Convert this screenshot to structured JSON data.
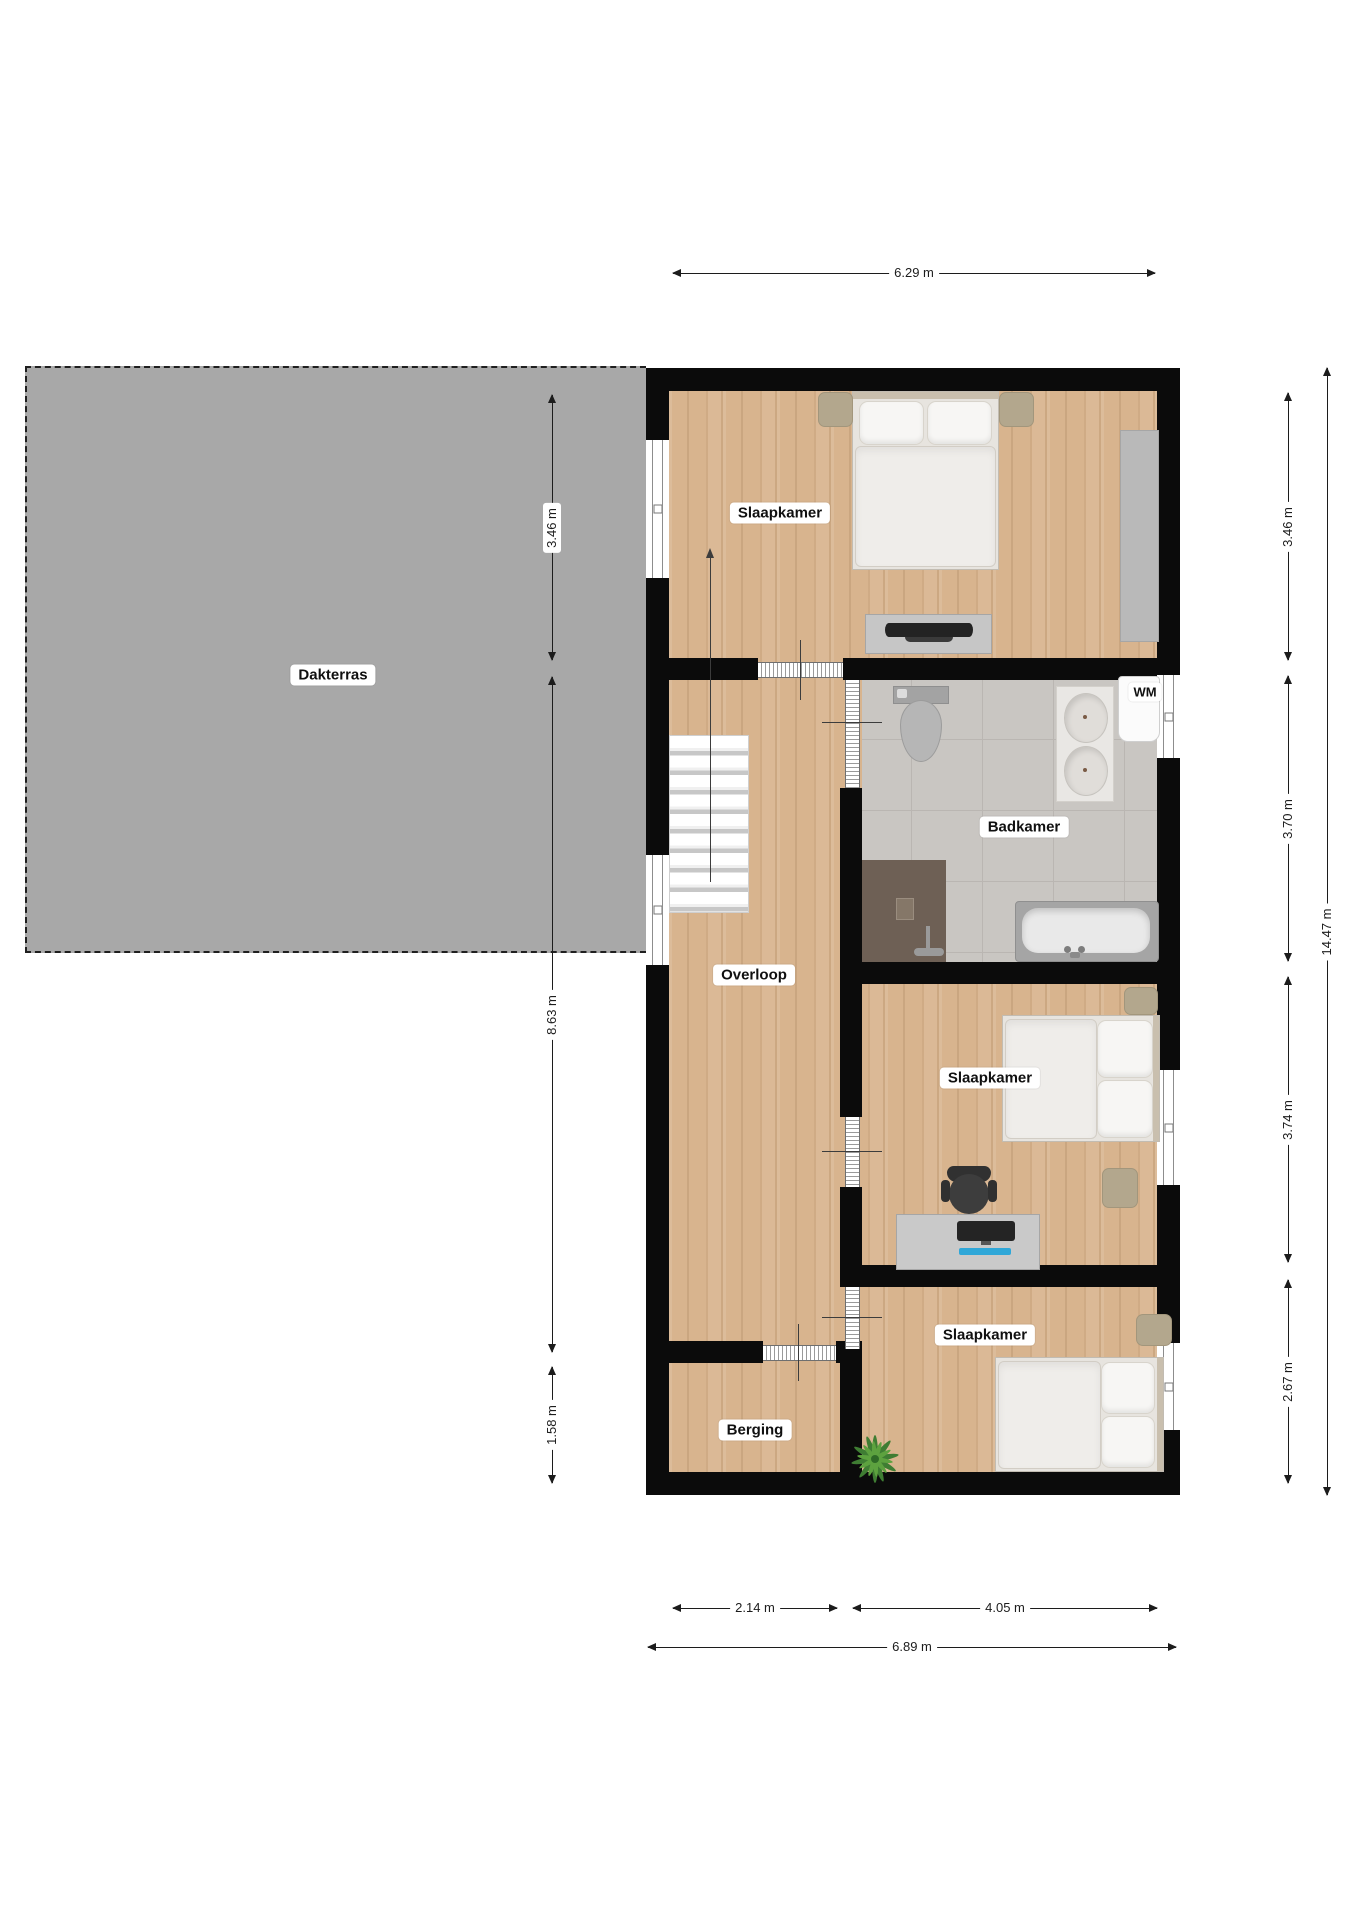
{
  "floorplan": {
    "rooms": {
      "dakterras": "Dakterras",
      "slaapkamer_boven": "Slaapkamer",
      "badkamer": "Badkamer",
      "overloop": "Overloop",
      "slaapkamer_midden": "Slaapkamer",
      "slaapkamer_onder": "Slaapkamer",
      "berging": "Berging",
      "wasmachine": "WM"
    },
    "dimensions": {
      "top_width": "6.29 m",
      "terrace_height": "3.46 m",
      "left_middle": "8.63 m",
      "left_bottom": "1.58 m",
      "right_room1": "3.46 m",
      "right_room2": "3.70 m",
      "right_room3": "3.74 m",
      "right_room4": "2.67 m",
      "right_total": "14.47 m",
      "bottom_left": "2.14 m",
      "bottom_right": "4.05 m",
      "bottom_total": "6.89 m"
    },
    "icons": {
      "furniture": [
        "double-bed",
        "nightstand",
        "wardrobe",
        "dresser-tv",
        "stairs",
        "toilet",
        "double-sink-vanity",
        "bathtub",
        "shower",
        "washing-machine",
        "desk",
        "office-chair",
        "plant",
        "window",
        "sliding-door"
      ]
    },
    "colors": {
      "wood_floor": "#d8b48e",
      "tile_floor": "#c9c6c2",
      "terrace": "#a8a8a8",
      "wall": "#0b0b0b"
    }
  }
}
